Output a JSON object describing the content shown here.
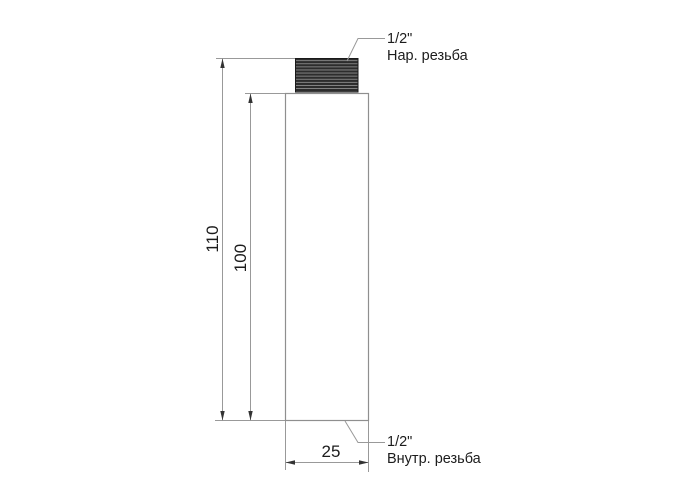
{
  "drawing": {
    "type": "pipe-extension-fitting-technical-drawing",
    "dimensions": {
      "total_height": "110",
      "body_height": "100",
      "width": "25"
    },
    "callouts": {
      "top": {
        "size": "1/2\"",
        "type": "Нар. резьба"
      },
      "bottom": {
        "size": "1/2\"",
        "type": "Внутр. резьба"
      }
    },
    "colors": {
      "background": "#ffffff",
      "line": "#999999",
      "outline": "#8f8f8f",
      "text": "#1c1c1c",
      "thread_dark": "#2c2c2c",
      "thread_ridge": "#8a8a8a",
      "arrow": "#333333"
    }
  }
}
